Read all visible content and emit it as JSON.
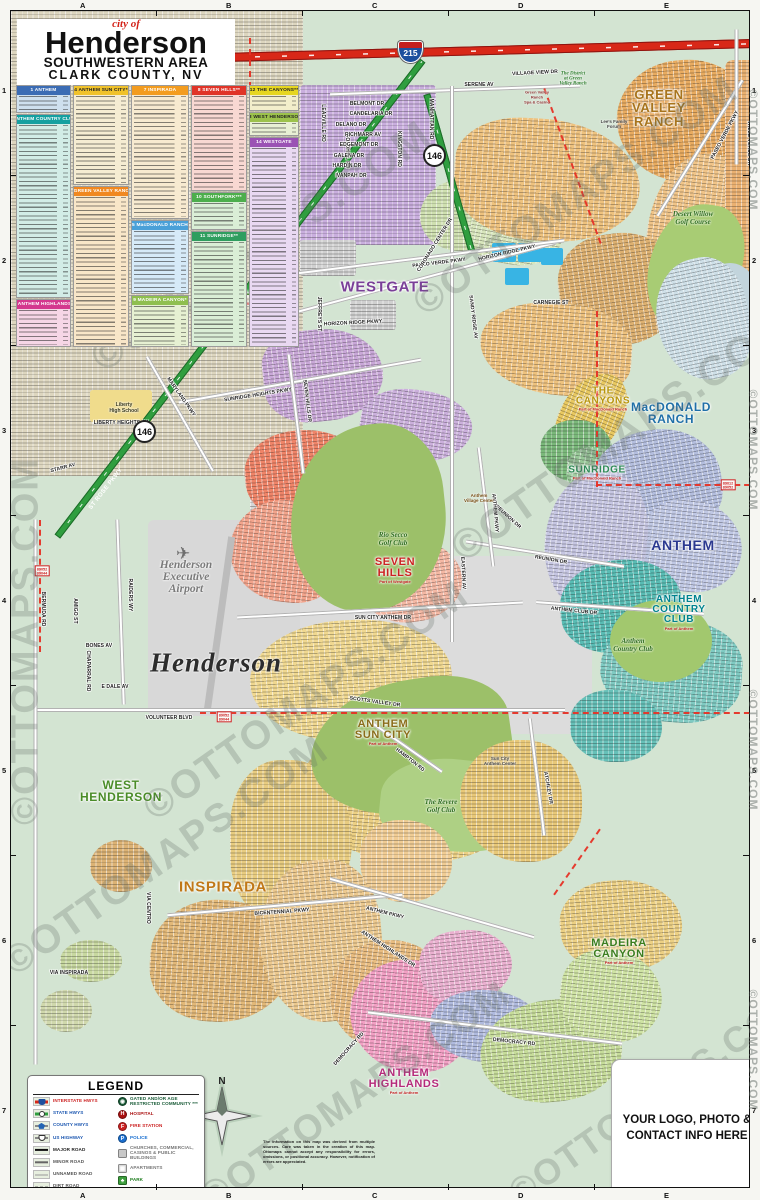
{
  "title": {
    "prefix": "city of",
    "name": "Henderson",
    "line2": "SOUTHWESTERN AREA",
    "line3": "CLARK COUNTY, NV"
  },
  "grid": {
    "cols": [
      "A",
      "B",
      "C",
      "D",
      "E"
    ],
    "rows": [
      "1",
      "2",
      "3",
      "4",
      "5",
      "6",
      "7"
    ]
  },
  "index": {
    "sections": [
      {
        "num": "1",
        "name": "ANTHEM",
        "hdr": "#3b6cb4",
        "txt": "#fff",
        "bg": "#cfe0ee",
        "x": 16,
        "y": 85,
        "w": 55,
        "h": 28
      },
      {
        "num": "2",
        "name": "ANTHEM COUNTRY CLUB*",
        "hdr": "#15a0a0",
        "txt": "#fff",
        "bg": "#d2ece6",
        "x": 16,
        "y": 114,
        "w": 55,
        "h": 184
      },
      {
        "num": "3",
        "name": "ANTHEM HIGHLANDS*",
        "hdr": "#d4388e",
        "txt": "#fff",
        "bg": "#f6d6e6",
        "x": 16,
        "y": 299,
        "w": 55,
        "h": 48
      },
      {
        "num": "4",
        "name": "ANTHEM SUN CITY*",
        "hdr": "#f0c22a",
        "txt": "#222",
        "bg": "#f5ecd2",
        "x": 73,
        "y": 85,
        "w": 56,
        "h": 100
      },
      {
        "num": "6",
        "name": "GREEN VALLEY RANCH",
        "hdr": "#f08820",
        "txt": "#fff",
        "bg": "#f8e6c8",
        "x": 73,
        "y": 186,
        "w": 56,
        "h": 161
      },
      {
        "num": "7",
        "name": "INSPIRADA",
        "hdr": "#f39c1f",
        "txt": "#fff",
        "bg": "#f7ead0",
        "x": 131,
        "y": 85,
        "w": 58,
        "h": 134
      },
      {
        "num": "5",
        "name": "MacDONALD RANCH",
        "hdr": "#4aa0d8",
        "txt": "#fff",
        "bg": "#d6eaf8",
        "x": 131,
        "y": 220,
        "w": 58,
        "h": 74
      },
      {
        "num": "9",
        "name": "MADEIRA CANYON*",
        "hdr": "#8fbf4f",
        "txt": "#fff",
        "bg": "#e6f0d2",
        "x": 131,
        "y": 295,
        "w": 58,
        "h": 52
      },
      {
        "num": "8",
        "name": "SEVEN HILLS**",
        "hdr": "#e03428",
        "txt": "#fff",
        "bg": "#f8d8d2",
        "x": 191,
        "y": 85,
        "w": 56,
        "h": 106
      },
      {
        "num": "10",
        "name": "SOUTHFORK***",
        "hdr": "#4cae4c",
        "txt": "#fff",
        "bg": "#daeed6",
        "x": 191,
        "y": 192,
        "w": 56,
        "h": 38
      },
      {
        "num": "11",
        "name": "SUNRIDGE**",
        "hdr": "#2f9e5f",
        "txt": "#fff",
        "bg": "#daeed6",
        "x": 191,
        "y": 231,
        "w": 56,
        "h": 116
      },
      {
        "num": "12",
        "name": "THE CANYONS**",
        "hdr": "#e6d620",
        "txt": "#222",
        "bg": "#f2eecb",
        "x": 249,
        "y": 85,
        "w": 50,
        "h": 26
      },
      {
        "num": "13",
        "name": "WEST HENDERSON",
        "hdr": "#9cc24c",
        "txt": "#222",
        "bg": "#e8f0d4",
        "x": 249,
        "y": 112,
        "w": 50,
        "h": 24
      },
      {
        "num": "14",
        "name": "WESTGATE",
        "hdr": "#9a52b4",
        "txt": "#fff",
        "bg": "#e9d9f2",
        "x": 249,
        "y": 137,
        "w": 50,
        "h": 210
      }
    ]
  },
  "map": {
    "compass_n": "N",
    "region_labels": [
      {
        "t": "GREEN\nVALLEY\nRANCH",
        "c": "#a8741c",
        "x": 648,
        "y": 97,
        "s": 13,
        "sub": ""
      },
      {
        "t": "SOUTHFORK",
        "c": "#3a7d1e",
        "x": 238,
        "y": 287,
        "s": 11,
        "sub": "Part of Westgate"
      },
      {
        "t": "WESTGATE",
        "c": "#7a3f98",
        "x": 374,
        "y": 276,
        "s": 15,
        "sub": ""
      },
      {
        "t": "THE\nCANYONS",
        "c": "#b8960c",
        "x": 592,
        "y": 388,
        "s": 10,
        "sub": "Part of MacDonald Ranch"
      },
      {
        "t": "MacDONALD\nRANCH",
        "c": "#1f6fa8",
        "x": 660,
        "y": 402,
        "s": 12,
        "sub": ""
      },
      {
        "t": "SUNRIDGE",
        "c": "#2e8b57",
        "x": 586,
        "y": 462,
        "s": 10,
        "sub": "Part of MacDonald Ranch"
      },
      {
        "t": "ANTHEM",
        "c": "#2b3990",
        "x": 672,
        "y": 534,
        "s": 14,
        "sub": ""
      },
      {
        "t": "ANTHEM\nCOUNTRY\nCLUB",
        "c": "#00838f",
        "x": 668,
        "y": 602,
        "s": 10,
        "sub": "Part of Anthem"
      },
      {
        "t": "SEVEN\nHILLS",
        "c": "#cc2222",
        "x": 384,
        "y": 560,
        "s": 11,
        "sub": "Part of Westgate"
      },
      {
        "t": "ANTHEM\nSUN CITY",
        "c": "#8a6d1a",
        "x": 372,
        "y": 722,
        "s": 11,
        "sub": "Part of Anthem"
      },
      {
        "t": "WEST\nHENDERSON",
        "c": "#4a8c28",
        "x": 110,
        "y": 780,
        "s": 12,
        "sub": ""
      },
      {
        "t": "INSPIRADA",
        "c": "#c07818",
        "x": 212,
        "y": 876,
        "s": 15,
        "sub": ""
      },
      {
        "t": "MADEIRA\nCANYON",
        "c": "#3a7d1e",
        "x": 608,
        "y": 941,
        "s": 11,
        "sub": "Part of Anthem"
      },
      {
        "t": "ANTHEM\nHIGHLANDS",
        "c": "#b52a7a",
        "x": 393,
        "y": 1071,
        "s": 11,
        "sub": "Part of Anthem"
      }
    ],
    "street_labels": [
      [
        "SERENE AV",
        468,
        74,
        0
      ],
      [
        "VILLAGE VIEW DR",
        524,
        62,
        -3
      ],
      [
        "PASEO VERDE PKWY",
        428,
        252,
        -7
      ],
      [
        "PASEO VERDE PKWY",
        714,
        124,
        -62
      ],
      [
        "VALLE VERDE DR",
        738,
        132,
        90
      ],
      [
        "MANHATTAN RD",
        420,
        108,
        90
      ],
      [
        "LEADVILLE RD",
        312,
        112,
        90
      ],
      [
        "EASTERN AV",
        251,
        144,
        90
      ],
      [
        "GOLDHILL RD",
        336,
        140,
        90
      ],
      [
        "KINGSTON RD",
        388,
        138,
        90
      ],
      [
        "BELMONT DR",
        356,
        93,
        0
      ],
      [
        "CANDELARIA DR",
        360,
        103,
        0
      ],
      [
        "DELANO DR",
        340,
        114,
        0
      ],
      [
        "RICHMARR AV",
        352,
        124,
        0
      ],
      [
        "EDGEMONT DR",
        348,
        134,
        0
      ],
      [
        "GALENA DR",
        338,
        145,
        0
      ],
      [
        "HARDIN DR",
        336,
        155,
        0
      ],
      [
        "IVANPAH DR",
        340,
        165,
        0
      ],
      [
        "CARNEGIE ST",
        540,
        292,
        0
      ],
      [
        "CORONADO CENTER DR",
        424,
        234,
        -58
      ],
      [
        "HORIZON RIDGE PKWY",
        342,
        312,
        -3
      ],
      [
        "HORIZON RIDGE PKWY",
        496,
        242,
        -13
      ],
      [
        "JEFFREYS ST",
        308,
        303,
        90
      ],
      [
        "SANDY RIDGE AV",
        462,
        306,
        83
      ],
      [
        "SUNRIDGE HEIGHTS PKWY",
        247,
        384,
        -9
      ],
      [
        "SEVEN HILLS DR",
        296,
        390,
        83
      ],
      [
        "MARYLAND PKWY",
        170,
        386,
        55
      ],
      [
        "ST ROSE PKWY",
        272,
        287,
        -52,
        "w"
      ],
      [
        "ST ROSE PKWY",
        95,
        478,
        -52,
        "w"
      ],
      [
        "LIBERTY HEIGHTS AV",
        110,
        412,
        0
      ],
      [
        "STARR AV",
        52,
        457,
        -15
      ],
      [
        "SUN CITY ANTHEM DR",
        372,
        607,
        0
      ],
      [
        "EASTERN AV",
        452,
        562,
        87
      ],
      [
        "REUNION DR",
        497,
        506,
        42
      ],
      [
        "REUNION DR",
        540,
        549,
        10
      ],
      [
        "ANTHEM CLUB DR",
        563,
        600,
        6
      ],
      [
        "ANTHEM PKWY",
        484,
        502,
        85
      ],
      [
        "BERMUDA RD",
        32,
        598,
        90
      ],
      [
        "RAIDERS WY",
        119,
        584,
        90
      ],
      [
        "AMIGO ST",
        64,
        600,
        90
      ],
      [
        "BONES AV",
        88,
        635,
        0
      ],
      [
        "E DALE AV",
        104,
        676,
        0
      ],
      [
        "CHAPARRAL RD",
        77,
        660,
        90
      ],
      [
        "VOLUNTEER BLVD",
        158,
        707,
        0
      ],
      [
        "VIA CENTRO",
        137,
        897,
        90
      ],
      [
        "VIA INSPIRADA",
        58,
        962,
        0
      ],
      [
        "BICENTENNIAL PKWY",
        271,
        901,
        -4
      ],
      [
        "ANTHEM PKWY",
        374,
        902,
        14
      ],
      [
        "ANTHEM HIGHLANDS DR",
        377,
        938,
        33
      ],
      [
        "DEMOCRACY RD",
        503,
        1031,
        6
      ],
      [
        "DEMOCRACY RD",
        338,
        1038,
        -48
      ],
      [
        "ATCHLEY DR",
        537,
        777,
        80
      ],
      [
        "HAMPTON RD",
        399,
        749,
        38
      ],
      [
        "SCOTTS VALLEY DR",
        364,
        691,
        8
      ]
    ],
    "place_labels": [
      {
        "t": "Henderson",
        "x": 205,
        "y": 652,
        "st": "pl-city"
      },
      {
        "t": "Henderson\nExecutive\nAirport",
        "x": 175,
        "y": 566,
        "st": "pl-airport"
      },
      {
        "t": "Liberty\nHigh School",
        "x": 113,
        "y": 397,
        "st": "pl-school"
      },
      {
        "t": "The District\nat Green\nValley Ranch",
        "x": 562,
        "y": 68,
        "st": "pl-gvr-district"
      },
      {
        "t": "Green Valley\nRanch\nSpa & Casino",
        "x": 526,
        "y": 86,
        "st": "pl-casino"
      },
      {
        "t": "Lee's Family\nForum",
        "x": 603,
        "y": 113,
        "st": "pl-poi"
      },
      {
        "t": "Rio Secco\nGolf Club",
        "x": 382,
        "y": 528,
        "st": "pl-golf"
      },
      {
        "t": "The Revere\nGolf Club",
        "x": 430,
        "y": 795,
        "st": "pl-golf"
      },
      {
        "t": "Anthem\nCountry Club",
        "x": 622,
        "y": 634,
        "st": "pl-golf"
      },
      {
        "t": "Desert Willow\nGolf Course",
        "x": 682,
        "y": 207,
        "st": "pl-golf"
      },
      {
        "t": "Anthem\nVillage Center",
        "x": 468,
        "y": 487,
        "st": "pl-poi-brown"
      },
      {
        "t": "Sun City\nAnthem Center",
        "x": 489,
        "y": 750,
        "st": "pl-poi"
      }
    ],
    "shields": [
      {
        "type": "interstate",
        "label": "215",
        "x": 399,
        "y": 41
      },
      {
        "type": "state",
        "label": "146",
        "x": 424,
        "y": 145
      },
      {
        "type": "state",
        "label": "146",
        "x": 134,
        "y": 421
      }
    ],
    "zip_tags": [
      {
        "t": "89012\n89052",
        "x": 717,
        "y": 474
      },
      {
        "t": "89052\n89044",
        "x": 213,
        "y": 706
      },
      {
        "t": "89052\n89044",
        "x": 31,
        "y": 560
      }
    ]
  },
  "legend": {
    "title": "LEGEND",
    "roads": [
      {
        "label": "INTERSTATE HWYS",
        "color": "#cc2222",
        "icon": "interstate"
      },
      {
        "label": "STATE HWYS",
        "color": "#1a56b0",
        "icon": "state"
      },
      {
        "label": "COUNTY HWYS",
        "color": "#1a56b0",
        "icon": "county"
      },
      {
        "label": "US HIGHWAY",
        "color": "#1a56b0",
        "icon": "us"
      },
      {
        "label": "MAJOR ROAD",
        "color": "#222222",
        "icon": "major"
      },
      {
        "label": "MINOR ROAD",
        "color": "#555555",
        "icon": "minor"
      },
      {
        "label": "UNNAMED ROAD",
        "color": "#555555",
        "icon": "unnamed"
      },
      {
        "label": "DIRT ROAD",
        "color": "#555555",
        "icon": "dirt"
      },
      {
        "label": "ZIP CODE BOUNDARIES",
        "color": "#cc2222",
        "icon": "zip"
      }
    ],
    "pois": [
      {
        "label": "GATED AND/OR AGE RESTRICTED COMMUNITY ***",
        "color": "#1a5c38",
        "chip": "#1a5c38",
        "glyph": "◉",
        "round": true
      },
      {
        "label": "HOSPITAL",
        "color": "#aa1111",
        "chip": "#aa1111",
        "glyph": "H",
        "round": true
      },
      {
        "label": "FIRE STATION",
        "color": "#cc2222",
        "chip": "#cc2222",
        "glyph": "F",
        "round": true
      },
      {
        "label": "POLICE",
        "color": "#1a6fd0",
        "chip": "#1a6fd0",
        "glyph": "P",
        "round": true
      },
      {
        "label": "CHURCHES, COMMERCIAL, CASINOS & PUBLIC BUILDINGS",
        "color": "#777777",
        "chip": "#c8c8c8",
        "glyph": "",
        "round": false
      },
      {
        "label": "APARTMENTS",
        "color": "#777777",
        "chip": "#d8d8d8",
        "glyph": "▦",
        "round": false
      },
      {
        "label": "PARK",
        "color": "#1a7a1a",
        "chip": "#3d9e3d",
        "glyph": "♣",
        "round": false
      },
      {
        "label": "SHOPPING CENTER",
        "color": "#e07818",
        "chip": "#f0a030",
        "glyph": "▤",
        "round": false
      },
      {
        "label": "GOLF COURSE",
        "color": "#1a6a1a",
        "chip": "#8fbf5f",
        "glyph": "⚑",
        "round": false
      },
      {
        "label": "SCHOOL",
        "color": "#1a4a6a",
        "chip": "#d8b878",
        "glyph": "⌂",
        "round": false
      }
    ],
    "credit": "MAP BY OTTOMAPS.COM"
  },
  "contact": {
    "line1": "YOUR LOGO, PHOTO &",
    "line2": "CONTACT INFO HERE"
  },
  "footer": {
    "disclaimer": "The information on this map was derived from multiple sources. Care was taken in the creation of this map. Ottomaps cannot accept any responsibility for errors, omissions, or positional accuracy. However, notification of errors are appreciated."
  },
  "watermark": {
    "text": "©OTTOMAPS.COM"
  }
}
